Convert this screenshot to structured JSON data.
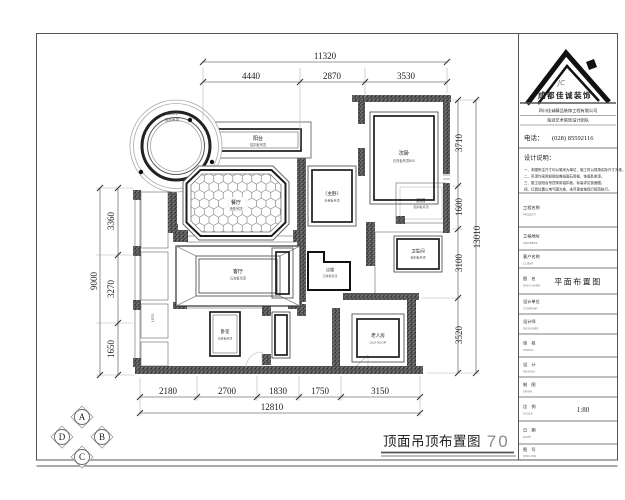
{
  "drawing": {
    "title": "顶面吊顶布置图",
    "scale": "1：70"
  },
  "dims": {
    "top": {
      "total": "11320",
      "segs": [
        "4440",
        "2870",
        "3530"
      ]
    },
    "left": {
      "total": "9000",
      "segs": [
        "3360",
        "3270",
        "1650"
      ]
    },
    "right": {
      "total": "13010",
      "segs": [
        "3710",
        "1600",
        "3100",
        "3520"
      ]
    },
    "bottom": {
      "total": "12810",
      "segs": [
        "2180",
        "2700",
        "1830",
        "1750",
        "3150"
      ]
    }
  },
  "rooms": {
    "entry_circle": {
      "code": "CD3-2",
      "note": "圆形吊顶"
    },
    "balcony": {
      "name": "阳台",
      "note": "铝扣板吊顶"
    },
    "dining": {
      "name": "餐厅",
      "note": "造型吊顶"
    },
    "bedroom2": {
      "name": "次卧",
      "note": "石膏板吊顶800"
    },
    "kitchen": {
      "name": "厨房",
      "note": "铝扣板吊顶"
    },
    "master": {
      "name": "（主卧）",
      "note": "石膏板吊顶"
    },
    "bath": {
      "name": "卫生间",
      "note": "铝扣板吊顶"
    },
    "living": {
      "name": "客厅",
      "note": "石膏板吊顶"
    },
    "hall": {
      "name": "过道",
      "note": "石膏板吊顶"
    },
    "bedroom3": {
      "name": "卧室",
      "note": "石膏板吊顶"
    },
    "elder": {
      "name": "老人房",
      "note": "OLD ROOM"
    },
    "left_note": "1570"
  },
  "compass": {
    "a": "A",
    "b": "B",
    "c": "C",
    "d": "D"
  },
  "title_block": {
    "logo": {
      "monogram": "JC",
      "company": "成都佳诚装饰"
    },
    "company_line1": "四川佳诚精品装饰工程有限公司",
    "company_line2": "海派艺术装饰设计团队",
    "phone_label": "电话：",
    "phone": "(028) 85592116",
    "notes_title": "设计说明：",
    "notes": [
      "一、本图所注尺寸均以毫米为单位，施工时以现场实际尺寸为准。",
      "二、吊顶均采用轻钢龙骨纸面石膏板，饰面乳胶漆。",
      "三、厨卫及阳台吊顶采用铝扣板，标高详见剖面图。",
      "四、灯具位置以电气图为准，未尽事宜按现行规范执行。"
    ],
    "rows": [
      {
        "label": "工程名称",
        "sub": "PROJECT",
        "value": ""
      },
      {
        "label": "工程地址",
        "sub": "ADDRESS",
        "value": ""
      },
      {
        "label": "客户名称",
        "sub": "CLIENT",
        "value": ""
      },
      {
        "label": "图　名",
        "sub": "DWG NAME",
        "value": "平面布置图"
      },
      {
        "label": "设计单位",
        "sub": "COMPANY",
        "value": ""
      },
      {
        "label": "设计师",
        "sub": "DESIGNER",
        "value": ""
      },
      {
        "label": "审　核",
        "sub": "CHECK",
        "value": ""
      },
      {
        "label": "设　计",
        "sub": "DESIGN",
        "value": ""
      },
      {
        "label": "制　图",
        "sub": "DRAW",
        "value": ""
      },
      {
        "label": "比　例",
        "sub": "SCALE",
        "value": "1:80"
      },
      {
        "label": "日　期",
        "sub": "DATE",
        "value": ""
      },
      {
        "label": "图　号",
        "sub": "DWG NO.",
        "value": ""
      }
    ]
  }
}
